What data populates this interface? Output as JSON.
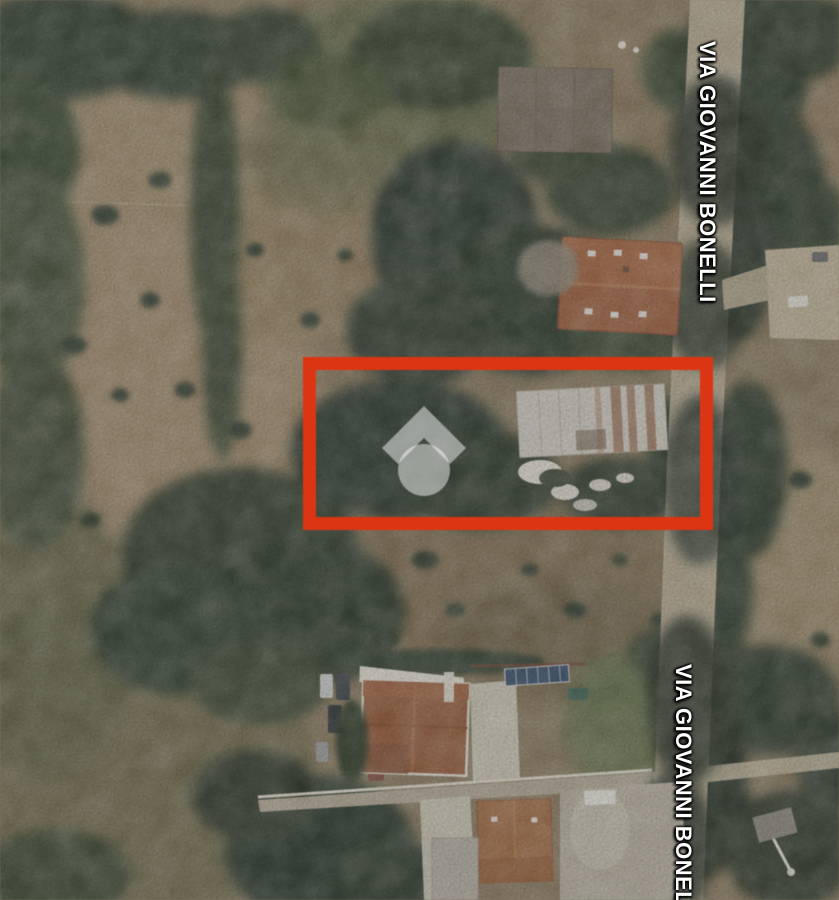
{
  "map": {
    "view": "satellite",
    "street_labels": [
      {
        "text": "VIA GIOVANNI BONELLI"
      },
      {
        "text": "VIA GIOVANNI BONELLI"
      }
    ],
    "highlight": {
      "shape": "rectangle",
      "stroke_color": "#e23410"
    },
    "watermark": {
      "icon": "house-logo",
      "color": "rgba(255,255,255,0.48)"
    }
  }
}
